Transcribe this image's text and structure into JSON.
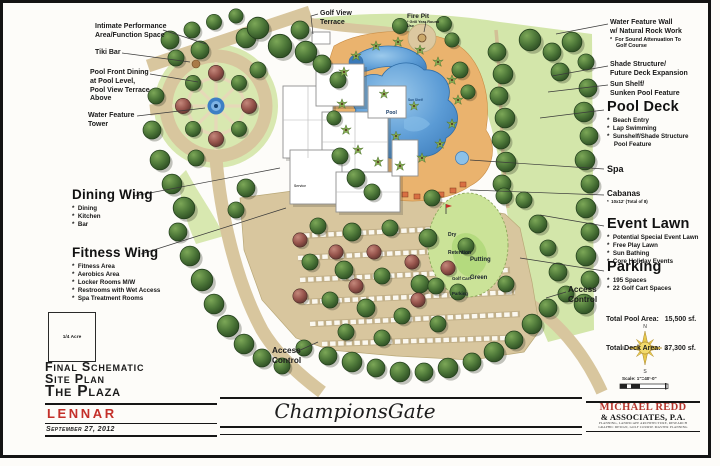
{
  "colors": {
    "lennar_red": "#c4302a",
    "redd_red": "#b5342c",
    "pool_blue": "#5b9bd5",
    "lawn_green": "#d3e6aa",
    "putting_green": "#b4da7e",
    "tree_green": "#4c7638",
    "road_tan": "#d8c69e",
    "deck_orange": "#eab36e"
  },
  "annotations": {
    "topleft": {
      "intimate": [
        "Intimate Performance",
        "Area/Function Space"
      ],
      "tiki": "Tiki Bar",
      "poolfront": [
        "Pool Front Dining",
        "at Pool Level,",
        "Pool View Terrace",
        "Above"
      ],
      "watertower": [
        "Water Feature",
        "Tower"
      ]
    },
    "top": {
      "golfview": [
        "Golf View",
        "Terrace"
      ],
      "firepit": {
        "title": "Fire Pit",
        "note": "* Grill Year Round Use"
      }
    },
    "left": {
      "dining": {
        "title": "Dining Wing",
        "bullets": [
          "*  Dining",
          "*  Kitchen",
          "*  Bar"
        ]
      },
      "fitness": {
        "title": "Fitness Wing",
        "bullets": [
          "*  Fitness Area",
          "*  Aerobics Area",
          "*  Locker Rooms M/W",
          "*  Restrooms with Wet Access",
          "*  Spa Treatment Rooms"
        ]
      },
      "access_bottom": [
        "Access",
        "Control"
      ]
    },
    "right": {
      "waterwall": {
        "lines": [
          "Water Feature Wall",
          "w/ Natural Rock Work"
        ],
        "notes": [
          "*  For Sound Attenuation To",
          "    Golf Course"
        ]
      },
      "shade": [
        "Shade Structure/",
        "Future Deck Expansion"
      ],
      "sunshelf": [
        "Sun Shelf/",
        "Sunken Pool Feature"
      ],
      "pooldeck": {
        "title": "Pool Deck",
        "bullets": [
          "*  Beach Entry",
          "*  Lap Swimming",
          "*  Sunshelf/Shade Structure",
          "    Pool Feature"
        ]
      },
      "spa": "Spa",
      "cabanas": {
        "title": "Cabanas",
        "note": "*  10x12' (Total of 8)"
      },
      "eventlawn": {
        "title": "Event Lawn",
        "bullets": [
          "*  Potential Special Event Lawn",
          "*  Free Play Lawn",
          "*  Sun Bathing",
          "*  Core Holiday Events"
        ]
      },
      "parking": {
        "title": "Parking",
        "bullets": [
          "*  195 Spaces",
          "*  22 Golf Cart Spaces"
        ]
      },
      "access_right": [
        "Access",
        "Control"
      ],
      "totals": [
        "Total Pool Area:   15,500 sf.",
        "Total Deck Area:  37,300 sf."
      ]
    }
  },
  "plan_labels": {
    "pool": "Pool",
    "sun_shelf": "Sun Shelf",
    "service": "Service",
    "dry1": "Dry",
    "dry2": "Retention",
    "putting1": "Putting",
    "putting2": "Green",
    "cart1": "Golf Cart",
    "cart2": "Parking"
  },
  "compass": {
    "n": "N",
    "e": "E",
    "s": "S",
    "w": "W"
  },
  "scale": {
    "label": "Scale: 1\"=40'-0\""
  },
  "title_block": {
    "box": "1/4 Acre",
    "line1": "Final Schematic",
    "line2": "Site Plan",
    "line3": "The Plaza",
    "company": "LENNAR",
    "date": "September 27, 2012"
  },
  "footer": {
    "project": "ChampionsGate",
    "firm1": "MICHAEL REDD",
    "firm2": "& ASSOCIATES, P.A.",
    "firm3": "PLANNING, LANDSCAPE ARCHITECTURE, RESEARCH",
    "firm4": "GRAPHIC DESIGN, GOLF COURSE MASTER PLANNING"
  }
}
